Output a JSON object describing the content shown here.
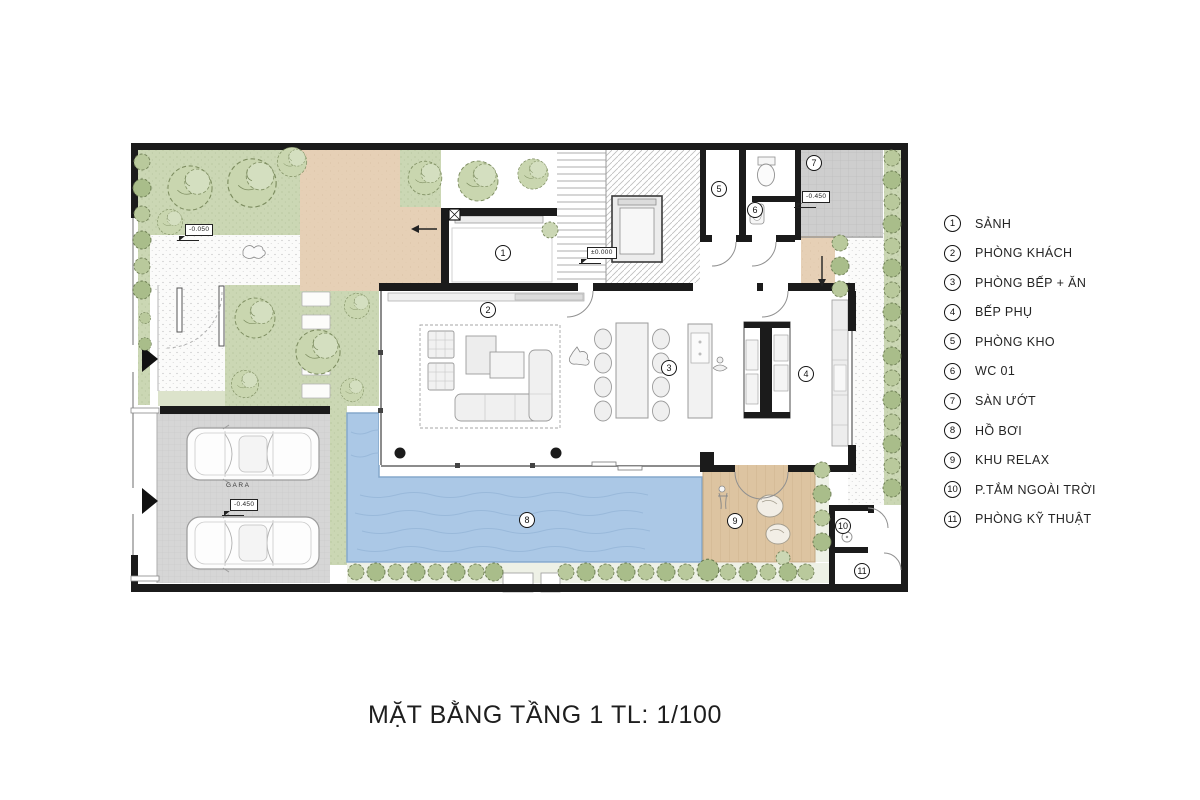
{
  "title": "MẶT BẰNG TẦNG 1 TL: 1/100",
  "legend": {
    "items": [
      {
        "num": "1",
        "label": "SẢNH"
      },
      {
        "num": "2",
        "label": "PHÒNG KHÁCH"
      },
      {
        "num": "3",
        "label": "PHÒNG BẾP + ĂN"
      },
      {
        "num": "4",
        "label": "BẾP PHỤ"
      },
      {
        "num": "5",
        "label": "PHÒNG KHO"
      },
      {
        "num": "6",
        "label": "WC 01"
      },
      {
        "num": "7",
        "label": "SÀN ƯỚT"
      },
      {
        "num": "8",
        "label": "HỒ BƠI"
      },
      {
        "num": "9",
        "label": "KHU RELAX"
      },
      {
        "num": "10",
        "label": "P.TẮM NGOÀI TRỜI"
      },
      {
        "num": "11",
        "label": "PHÒNG KỸ THUẬT"
      }
    ]
  },
  "plan": {
    "annotations": {
      "garage_label": "GARA",
      "elev_main": "±0.000",
      "elev_wet": "-0.450",
      "elev_garage": "-0.450",
      "elev_garden": "-0.050"
    },
    "colors": {
      "wall_black": "#1b1b1b",
      "pool_blue": "#abc8e6",
      "greenery": "#cbd7b4",
      "terrace_tan": "#e6d0b6",
      "deck_wood": "#ddc4a1",
      "paving_gray": "#d6d6d6"
    }
  }
}
